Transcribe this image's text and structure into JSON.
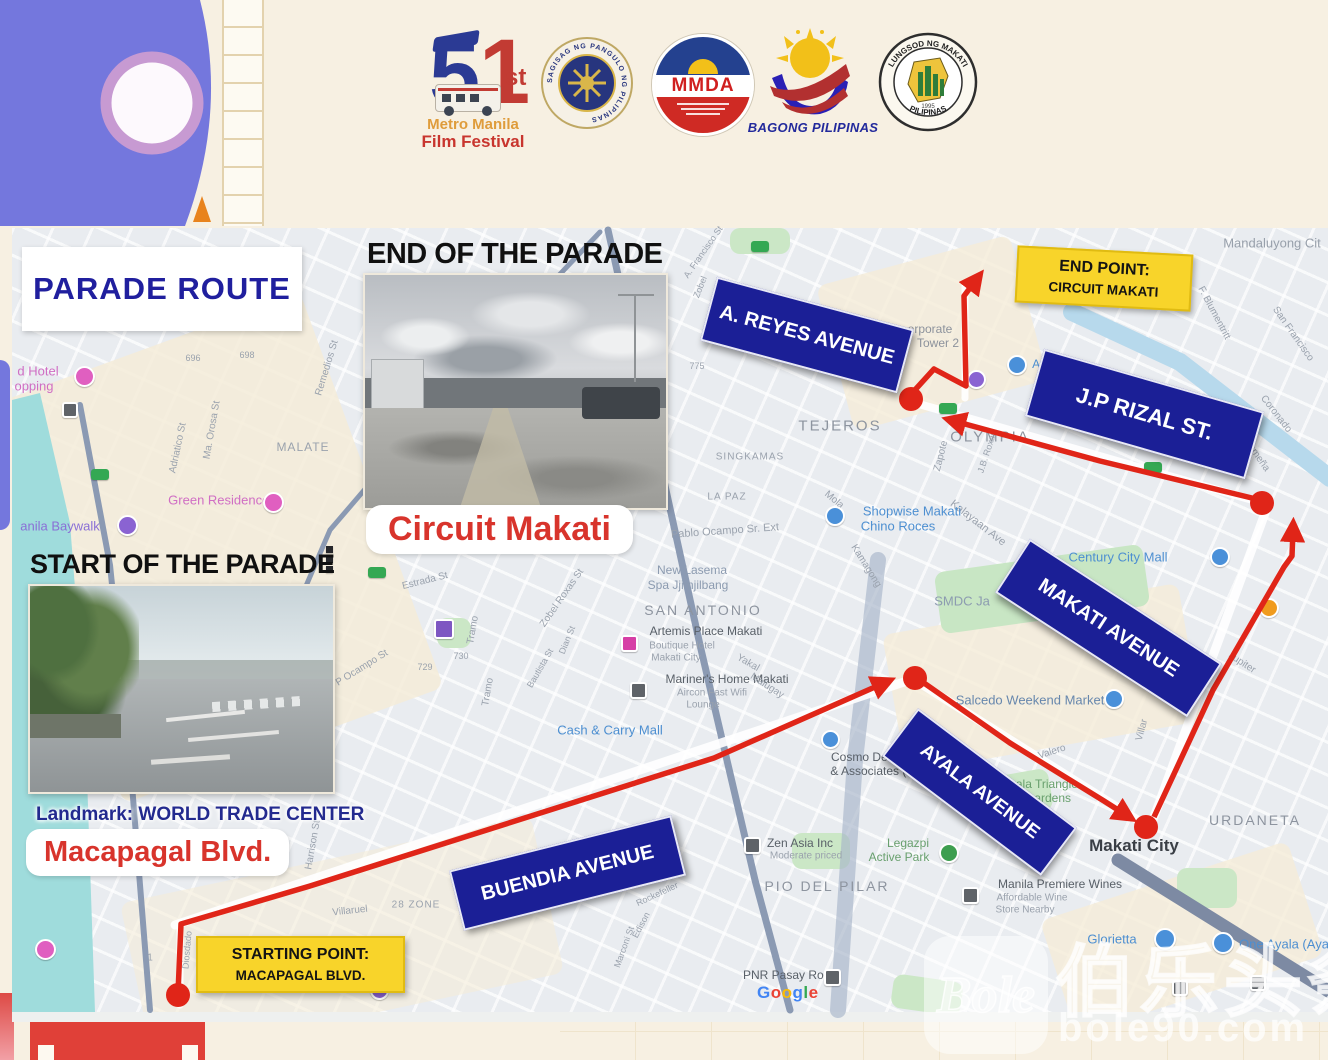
{
  "header": {
    "mmff": {
      "digit5": "5",
      "digit1": "1",
      "suffix": "st",
      "line1": "Metro Manila",
      "line2": "Film Festival"
    },
    "presidential_seal_text": "SAGISAG NG PANGULO NG PILIPINAS",
    "mmda_label": "MMDA",
    "bagong_label": "BAGONG PILIPINAS",
    "makati_seal": {
      "top": "LUNGSOD NG MAKATI",
      "bottom": "PILIPINAS",
      "year": "1995"
    }
  },
  "titles": {
    "parade_route": "PARADE ROUTE",
    "end_of_parade": "END OF THE PARADE",
    "start_of_parade": "START OF THE PARADE",
    "circuit_makati": "Circuit Makati",
    "landmark": "Landmark: WORLD TRADE CENTER",
    "macapagal": "Macapagal Blvd."
  },
  "signs": {
    "a_reyes": "A. REYES AVENUE",
    "jp_rizal": "J.P RIZAL ST.",
    "makati_ave": "MAKATI AVENUE",
    "ayala": "AYALA AVENUE",
    "buendia": "BUENDIA AVENUE"
  },
  "points": {
    "end": {
      "line1": "END POINT:",
      "line2": "CIRCUIT MAKATI"
    },
    "start": {
      "line1": "STARTING POINT:",
      "line2": "MACAPAGAL BLVD."
    }
  },
  "watermark": {
    "logo": "Bole",
    "cn": "伯乐头条",
    "url": "bole90.com"
  },
  "map": {
    "accent_colors": {
      "route_red": "#e02518",
      "sign_navy": "#1b1f96",
      "point_yellow": "#f8d42a"
    },
    "google": [
      {
        "c": "G",
        "color": "#4285F4"
      },
      {
        "c": "o",
        "color": "#EA4335"
      },
      {
        "c": "o",
        "color": "#FBBC05"
      },
      {
        "c": "g",
        "color": "#4285F4"
      },
      {
        "c": "l",
        "color": "#34A853"
      },
      {
        "c": "e",
        "color": "#EA4335"
      }
    ],
    "route": {
      "color": "#e02518",
      "segments": [
        {
          "p": "178,993 181,924 310,886 714,758 884,683"
        },
        {
          "p": "924,683 1010,743 1104,801 1126,815"
        },
        {
          "p": "1154,817 1213,690 1284,567 1292,556 1293,530"
        },
        {
          "p": "1256,499 1100,461 954,421"
        },
        {
          "p": "914,391 934,369 966,386 964,296 976,280"
        }
      ],
      "dots": [
        [
          178,
          995
        ],
        [
          915,
          678
        ],
        [
          1146,
          827
        ],
        [
          1262,
          503
        ],
        [
          911,
          399
        ]
      ]
    },
    "labels": [
      {
        "t": "Mandaluyong Cit",
        "x": 1272,
        "y": 243,
        "fs": 13,
        "c": "#98a0ab",
        "w": 500
      },
      {
        "t": "VERGARA",
        "x": 1092,
        "y": 288,
        "fs": 10,
        "c": "#9aa2ad",
        "ls": 1
      },
      {
        "t": "TEJEROS",
        "x": 840,
        "y": 426,
        "fs": 15,
        "c": "#8d949f",
        "ls": 2,
        "w": 500
      },
      {
        "t": "OLYMPIA",
        "x": 990,
        "y": 437,
        "fs": 15,
        "c": "#8d949f",
        "ls": 2,
        "w": 500
      },
      {
        "t": "SINGKAMAS",
        "x": 750,
        "y": 457,
        "fs": 10,
        "c": "#9aa2ad",
        "ls": 1
      },
      {
        "t": "LA PAZ",
        "x": 727,
        "y": 497,
        "fs": 10,
        "c": "#9aa2ad",
        "ls": 1
      },
      {
        "t": "SAN ANTONIO",
        "x": 703,
        "y": 610,
        "fs": 14,
        "c": "#8d949f",
        "ls": 2,
        "w": 500
      },
      {
        "t": "MALATE",
        "x": 303,
        "y": 447,
        "fs": 12,
        "c": "#9aa2ad",
        "ls": 1
      },
      {
        "t": "PIO DEL PILAR",
        "x": 827,
        "y": 886,
        "fs": 14,
        "c": "#8d949f",
        "ls": 2,
        "w": 500
      },
      {
        "t": "URDANETA",
        "x": 1255,
        "y": 820,
        "fs": 14,
        "c": "#8d949f",
        "ls": 2,
        "w": 500
      },
      {
        "t": "Makati City",
        "x": 1134,
        "y": 846,
        "fs": 17,
        "c": "#3a3f46",
        "w": 700
      },
      {
        "t": "SMDC Ja",
        "x": 962,
        "y": 601,
        "fs": 13,
        "c": "#8c9bb0",
        "w": 500
      },
      {
        "t": "Century City Mall",
        "x": 1118,
        "y": 557,
        "fs": 13,
        "c": "#4d8fd1",
        "w": 500
      },
      {
        "t": "Salcedo Weekend Market",
        "x": 1030,
        "y": 700,
        "fs": 13,
        "c": "#6787ad",
        "w": 500
      },
      {
        "t": "Ayala Triangle",
        "x": 1040,
        "y": 784,
        "fs": 12,
        "c": "#69a06e",
        "w": 500
      },
      {
        "t": "Gardens",
        "x": 1048,
        "y": 798,
        "fs": 12,
        "c": "#69a06e",
        "w": 500
      },
      {
        "t": "Valero",
        "x": 1052,
        "y": 752,
        "fs": 10,
        "c": "#9aa2ad",
        "r": -18
      },
      {
        "t": "Villar",
        "x": 1142,
        "y": 730,
        "fs": 10,
        "c": "#9aa2ad",
        "r": -75
      },
      {
        "t": "Jupiter",
        "x": 1242,
        "y": 663,
        "fs": 10,
        "c": "#9aa2ad",
        "r": 33
      },
      {
        "t": "Kalayaan Ave",
        "x": 978,
        "y": 523,
        "fs": 11,
        "c": "#9aa2ad",
        "r": 38
      },
      {
        "t": "J.B. Roxas",
        "x": 987,
        "y": 452,
        "fs": 9,
        "c": "#9aa2ad",
        "r": -72
      },
      {
        "t": "Zapote",
        "x": 941,
        "y": 456,
        "fs": 10,
        "c": "#9aa2ad",
        "r": -76
      },
      {
        "t": "Mola",
        "x": 834,
        "y": 500,
        "fs": 10,
        "c": "#9aa2ad",
        "r": 40
      },
      {
        "t": "Kamagong",
        "x": 866,
        "y": 566,
        "fs": 10,
        "c": "#9aa2ad",
        "r": 58
      },
      {
        "t": "Pablo Ocampo Sr. Ext",
        "x": 725,
        "y": 531,
        "fs": 11,
        "c": "#9aa2ad",
        "r": -4
      },
      {
        "t": "New Lasema",
        "x": 692,
        "y": 570,
        "fs": 12,
        "c": "#8c9bb0",
        "w": 500
      },
      {
        "t": "Spa Jjimjilbang",
        "x": 688,
        "y": 585,
        "fs": 12,
        "c": "#8c9bb0",
        "w": 500
      },
      {
        "t": "Artemis Place Makati",
        "x": 706,
        "y": 631,
        "fs": 12,
        "c": "#596068",
        "w": 500
      },
      {
        "t": "Boutique Hotel",
        "x": 682,
        "y": 646,
        "fs": 10,
        "c": "#9aa2ad"
      },
      {
        "t": "Makati City",
        "x": 676,
        "y": 658,
        "fs": 10,
        "c": "#9aa2ad"
      },
      {
        "t": "Mariner's Home Makati",
        "x": 727,
        "y": 679,
        "fs": 12,
        "c": "#596068",
        "w": 500
      },
      {
        "t": "Aircon Fast Wifi",
        "x": 712,
        "y": 693,
        "fs": 10,
        "c": "#9aa2ad"
      },
      {
        "t": "Lounge",
        "x": 703,
        "y": 705,
        "fs": 10,
        "c": "#9aa2ad"
      },
      {
        "t": "Cash & Carry Mall",
        "x": 610,
        "y": 730,
        "fs": 13,
        "c": "#4d8fd1",
        "w": 500
      },
      {
        "t": "Cosmo Dental Bu",
        "x": 878,
        "y": 757,
        "fs": 12,
        "c": "#596068",
        "w": 500
      },
      {
        "t": "& Associates (T",
        "x": 872,
        "y": 771,
        "fs": 12,
        "c": "#596068",
        "w": 500
      },
      {
        "t": "Shopwise Makati",
        "x": 912,
        "y": 511,
        "fs": 13,
        "c": "#4d8fd1",
        "w": 500
      },
      {
        "t": "Chino Roces",
        "x": 898,
        "y": 526,
        "fs": 13,
        "c": "#4d8fd1",
        "w": 500
      },
      {
        "t": "Zen Asia Inc",
        "x": 800,
        "y": 843,
        "fs": 12,
        "c": "#596068",
        "w": 500
      },
      {
        "t": "Moderate priced",
        "x": 806,
        "y": 856,
        "fs": 10,
        "c": "#9aa2ad"
      },
      {
        "t": "Legazpi",
        "x": 908,
        "y": 843,
        "fs": 12,
        "c": "#69a06e",
        "w": 500
      },
      {
        "t": "Active Park",
        "x": 899,
        "y": 857,
        "fs": 12,
        "c": "#69a06e",
        "w": 500
      },
      {
        "t": "Manila Premiere Wines",
        "x": 1060,
        "y": 884,
        "fs": 12,
        "c": "#596068",
        "w": 500
      },
      {
        "t": "Affordable Wine",
        "x": 1032,
        "y": 898,
        "fs": 10,
        "c": "#9aa2ad"
      },
      {
        "t": "Store Nearby",
        "x": 1025,
        "y": 910,
        "fs": 10,
        "c": "#9aa2ad"
      },
      {
        "t": "Glorietta",
        "x": 1112,
        "y": 939,
        "fs": 13,
        "c": "#4d8fd1",
        "w": 500
      },
      {
        "t": "One Ayala (Aya",
        "x": 1284,
        "y": 944,
        "fs": 13,
        "c": "#4d8fd1",
        "w": 500
      },
      {
        "t": "PNR Pasay Road",
        "x": 790,
        "y": 975,
        "fs": 12,
        "c": "#596068",
        "w": 500
      },
      {
        "t": "Green Residences",
        "x": 222,
        "y": 500,
        "fs": 13,
        "c": "#d06ec4",
        "w": 500
      },
      {
        "t": "d Hotel",
        "x": 38,
        "y": 371,
        "fs": 13,
        "c": "#d06ec4",
        "w": 500
      },
      {
        "t": "opping",
        "x": 34,
        "y": 386,
        "fs": 13,
        "c": "#d06ec4",
        "w": 500
      },
      {
        "t": "anila Baywalk",
        "x": 60,
        "y": 526,
        "fs": 13,
        "c": "#8a6fd6",
        "w": 500
      },
      {
        "t": "Remedios St",
        "x": 327,
        "y": 368,
        "fs": 10,
        "c": "#9aa2ad",
        "r": -73
      },
      {
        "t": "Ma. Orosa St",
        "x": 212,
        "y": 430,
        "fs": 10,
        "c": "#9aa2ad",
        "r": -80
      },
      {
        "t": "Adriatico St",
        "x": 178,
        "y": 448,
        "fs": 10,
        "c": "#9aa2ad",
        "r": -78
      },
      {
        "t": "696",
        "x": 193,
        "y": 358,
        "fs": 9,
        "c": "#9aa2ad"
      },
      {
        "t": "698",
        "x": 247,
        "y": 355,
        "fs": 9,
        "c": "#9aa2ad"
      },
      {
        "t": "Estrada St",
        "x": 425,
        "y": 581,
        "fs": 10,
        "c": "#9aa2ad",
        "r": -14
      },
      {
        "t": "Zobel Roxas St",
        "x": 562,
        "y": 598,
        "fs": 10,
        "c": "#9aa2ad",
        "r": -55
      },
      {
        "t": "P Ocampo St",
        "x": 362,
        "y": 668,
        "fs": 10,
        "c": "#9aa2ad",
        "r": -32
      },
      {
        "t": "730",
        "x": 461,
        "y": 656,
        "fs": 9,
        "c": "#9aa2ad"
      },
      {
        "t": "729",
        "x": 425,
        "y": 667,
        "fs": 9,
        "c": "#9aa2ad"
      },
      {
        "t": "Tramo",
        "x": 473,
        "y": 630,
        "fs": 10,
        "c": "#9aa2ad",
        "r": -80
      },
      {
        "t": "Tramo",
        "x": 488,
        "y": 692,
        "fs": 10,
        "c": "#9aa2ad",
        "r": -80
      },
      {
        "t": "Bautista St",
        "x": 540,
        "y": 668,
        "fs": 9,
        "c": "#9aa2ad",
        "r": -60
      },
      {
        "t": "Dian St",
        "x": 567,
        "y": 640,
        "fs": 9,
        "c": "#9aa2ad",
        "r": -68
      },
      {
        "t": "775",
        "x": 697,
        "y": 366,
        "fs": 9,
        "c": "#9aa2ad"
      },
      {
        "t": "F. Blumentritt",
        "x": 1214,
        "y": 313,
        "fs": 10,
        "c": "#9aa2ad",
        "r": 62
      },
      {
        "t": "San Francisco",
        "x": 1293,
        "y": 334,
        "fs": 10,
        "c": "#9aa2ad",
        "r": 55
      },
      {
        "t": "Coronado",
        "x": 1276,
        "y": 414,
        "fs": 10,
        "c": "#9aa2ad",
        "r": 52
      },
      {
        "t": "S. Osmeña",
        "x": 1253,
        "y": 450,
        "fs": 10,
        "c": "#9aa2ad",
        "r": 55
      },
      {
        "t": "orporate",
        "x": 930,
        "y": 329,
        "fs": 12,
        "c": "#8c929c"
      },
      {
        "t": "Tower 2",
        "x": 938,
        "y": 343,
        "fs": 12,
        "c": "#8c929c"
      },
      {
        "t": "Ayala",
        "x": 1047,
        "y": 364,
        "fs": 12,
        "c": "#4d8fd1",
        "w": 500
      },
      {
        "t": "Yakal",
        "x": 748,
        "y": 663,
        "fs": 10,
        "c": "#9aa2ad",
        "r": 30
      },
      {
        "t": "Malugay",
        "x": 767,
        "y": 686,
        "fs": 10,
        "c": "#9aa2ad",
        "r": 33
      },
      {
        "t": "28 ZONE",
        "x": 416,
        "y": 905,
        "fs": 10,
        "c": "#9aa2ad",
        "ls": 1
      },
      {
        "t": "Villaruel",
        "x": 350,
        "y": 911,
        "fs": 10,
        "c": "#9aa2ad",
        "r": -6
      },
      {
        "t": "Dapitan",
        "x": 267,
        "y": 843,
        "fs": 10,
        "c": "#9aa2ad",
        "r": 42
      },
      {
        "t": "Marconi St",
        "x": 624,
        "y": 947,
        "fs": 9,
        "c": "#9aa2ad",
        "r": -70
      },
      {
        "t": "Edison",
        "x": 641,
        "y": 925,
        "fs": 9,
        "c": "#9aa2ad",
        "r": -62
      },
      {
        "t": "Rockefeller",
        "x": 657,
        "y": 894,
        "fs": 9,
        "c": "#9aa2ad",
        "r": -25
      },
      {
        "t": "N ISIDRO",
        "x": 646,
        "y": 863,
        "fs": 13,
        "c": "#8d949f",
        "ls": 2,
        "w": 500
      },
      {
        "t": "A. Francisco St",
        "x": 703,
        "y": 252,
        "fs": 9,
        "c": "#9aa2ad",
        "r": -55
      },
      {
        "t": "Zobel",
        "x": 700,
        "y": 287,
        "fs": 9,
        "c": "#9aa2ad",
        "r": -68
      },
      {
        "t": "Harrison St",
        "x": 313,
        "y": 845,
        "fs": 10,
        "c": "#9aa2ad",
        "r": -80
      },
      {
        "t": "Diosdado",
        "x": 187,
        "y": 950,
        "fs": 9,
        "c": "#9aa2ad",
        "r": -85
      },
      {
        "t": "1",
        "x": 150,
        "y": 958,
        "fs": 10,
        "c": "#9aa2ad"
      }
    ],
    "markers": [
      {
        "k": "c",
        "x": 833,
        "y": 514,
        "c": "#4a90d9",
        "s": 16
      },
      {
        "k": "c",
        "x": 1015,
        "y": 363,
        "c": "#4a90d9",
        "s": 16
      },
      {
        "k": "c",
        "x": 1218,
        "y": 555,
        "c": "#4a90d9",
        "s": 16
      },
      {
        "k": "c",
        "x": 1112,
        "y": 697,
        "c": "#4a90d9",
        "s": 16
      },
      {
        "k": "c",
        "x": 828,
        "y": 737,
        "c": "#4a90d9",
        "s": 15
      },
      {
        "k": "c",
        "x": 1163,
        "y": 937,
        "c": "#4a90d9",
        "s": 18
      },
      {
        "k": "c",
        "x": 1221,
        "y": 941,
        "c": "#4a90d9",
        "s": 18
      },
      {
        "k": "c",
        "x": 82,
        "y": 374,
        "c": "#e05fc0",
        "s": 17
      },
      {
        "k": "c",
        "x": 271,
        "y": 500,
        "c": "#e05fc0",
        "s": 17
      },
      {
        "k": "c",
        "x": 43,
        "y": 947,
        "c": "#e05fc0",
        "s": 17
      },
      {
        "k": "c",
        "x": 125,
        "y": 523,
        "c": "#8a63d2",
        "s": 17
      },
      {
        "k": "c",
        "x": 377,
        "y": 988,
        "c": "#8a63d2",
        "s": 15
      },
      {
        "k": "c",
        "x": 974,
        "y": 377,
        "c": "#8a63d2",
        "s": 15
      },
      {
        "k": "c",
        "x": 947,
        "y": 851,
        "c": "#3d9e4f",
        "s": 16
      },
      {
        "k": "c",
        "x": 1267,
        "y": 606,
        "c": "#f09b1e",
        "s": 16
      },
      {
        "k": "sq",
        "x": 750,
        "y": 843,
        "c": "#5f6368",
        "s": 13
      },
      {
        "k": "sq",
        "x": 830,
        "y": 975,
        "c": "#5f6368",
        "s": 13
      },
      {
        "k": "sq",
        "x": 968,
        "y": 893,
        "c": "#5f6368",
        "s": 13
      },
      {
        "k": "sq",
        "x": 636,
        "y": 688,
        "c": "#5f6368",
        "s": 13
      },
      {
        "k": "sq",
        "x": 68,
        "y": 408,
        "c": "#5f6368",
        "s": 12
      },
      {
        "k": "sq",
        "x": 1178,
        "y": 986,
        "c": "#5f6368",
        "s": 12
      },
      {
        "k": "sq",
        "x": 1256,
        "y": 981,
        "c": "#5f6368",
        "s": 12
      },
      {
        "k": "sq",
        "x": 627,
        "y": 641,
        "c": "#d63fa6",
        "s": 13
      },
      {
        "k": "sq",
        "x": 442,
        "y": 627,
        "c": "#7e57c2",
        "s": 16
      },
      {
        "k": "sh",
        "x": 377,
        "y": 572
      },
      {
        "k": "sh",
        "x": 948,
        "y": 408
      },
      {
        "k": "sh",
        "x": 1153,
        "y": 467
      },
      {
        "k": "sh",
        "x": 760,
        "y": 246
      },
      {
        "k": "sh",
        "x": 100,
        "y": 474
      },
      {
        "k": "bar",
        "x": 333,
        "y": 553
      },
      {
        "k": "bar",
        "x": 333,
        "y": 563
      },
      {
        "k": "bar",
        "x": 333,
        "y": 573
      }
    ]
  }
}
